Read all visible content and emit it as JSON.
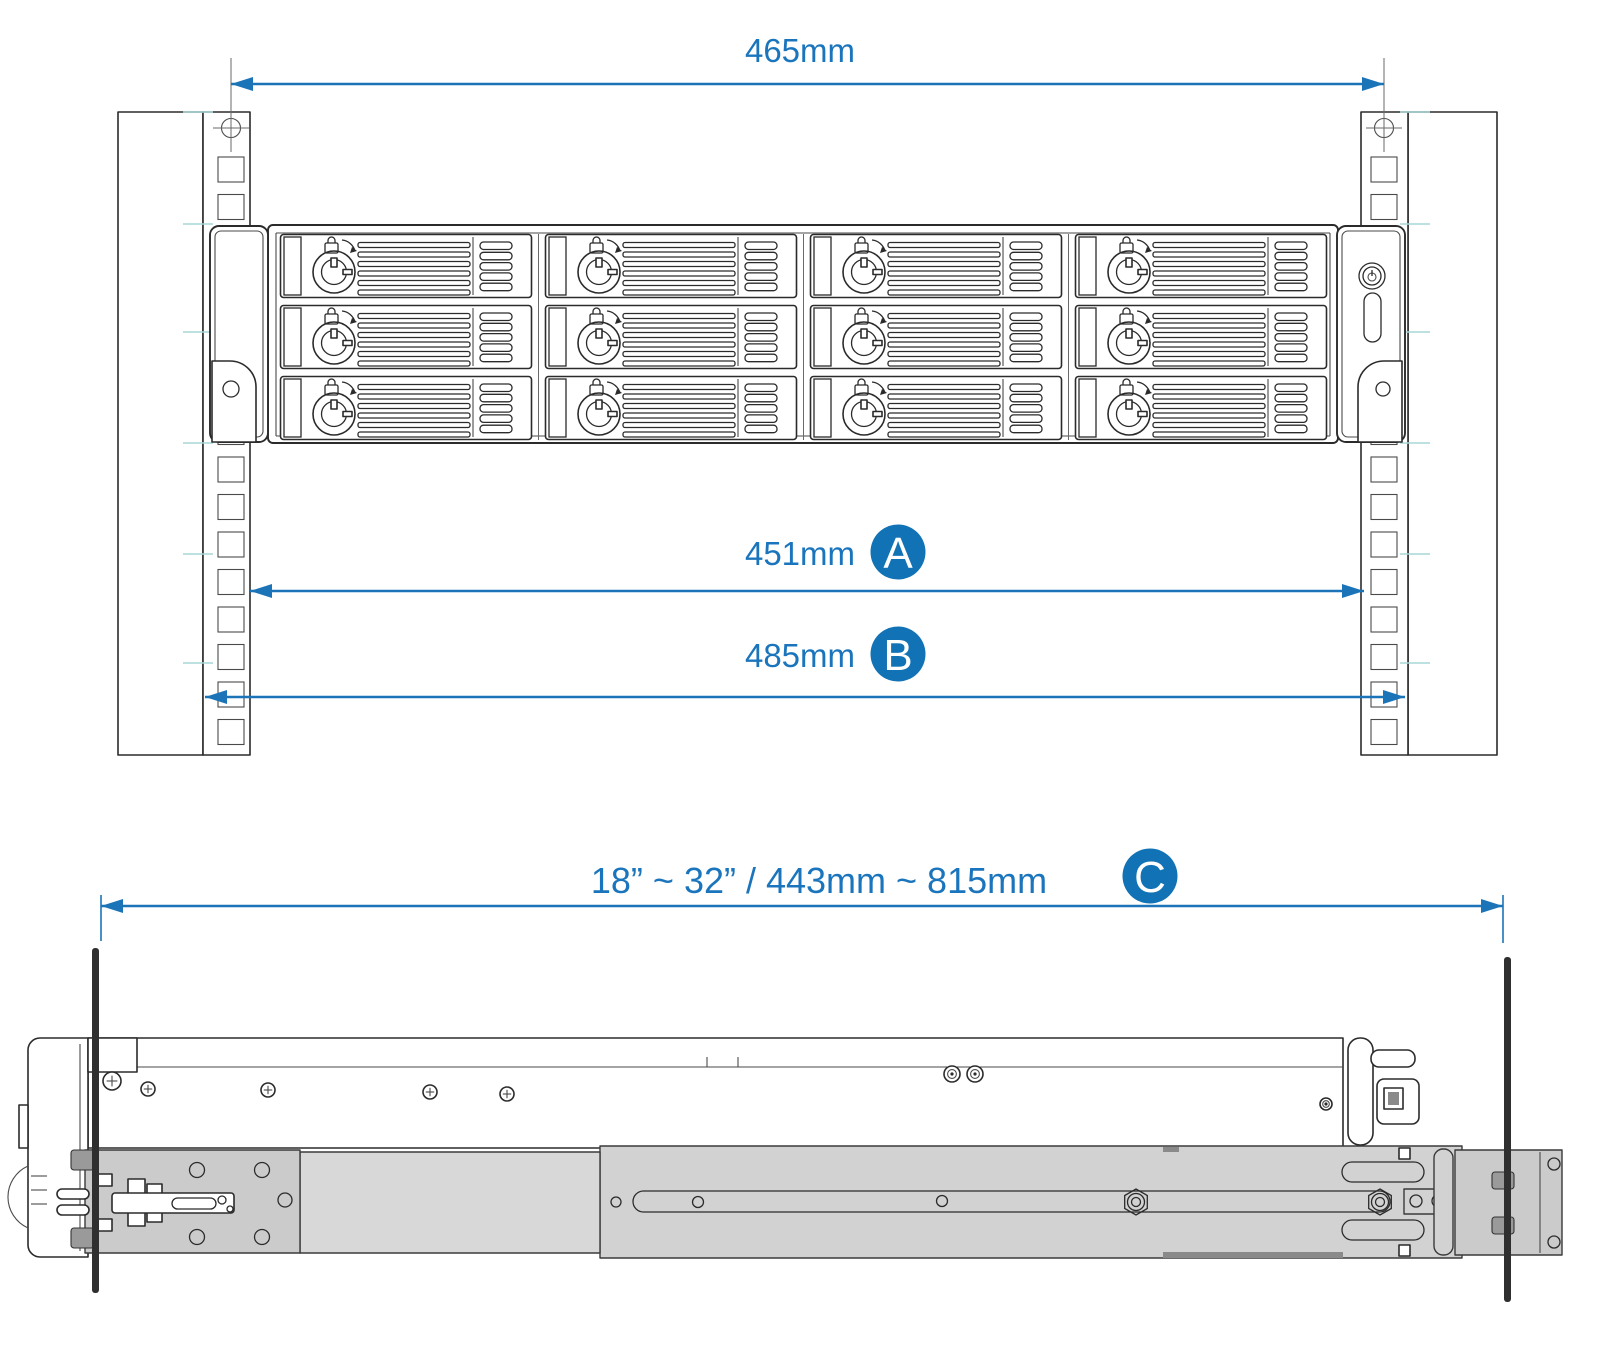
{
  "title": "Rackmount installation dimensions diagram",
  "colors": {
    "dimension_blue": "#1b74b8",
    "label_blue": "#1b75bc",
    "badge_blue": "#1172b5",
    "line_art": "#2b2b2b",
    "rail_gray": "#d2d2d2",
    "tick_teal": "#a7d6d6",
    "post_black": "#2f2f2f"
  },
  "front_view": {
    "hole_span": {
      "label": "465mm"
    },
    "chassis_width": {
      "label": "451mm",
      "badge": "A"
    },
    "overall_width": {
      "label": "485mm",
      "badge": "B"
    },
    "drive_bays": {
      "columns": 4,
      "rows": 3
    }
  },
  "side_view": {
    "rail_depth": {
      "label": "18” ~ 32”  /  443mm ~ 815mm",
      "badge": "C"
    }
  }
}
